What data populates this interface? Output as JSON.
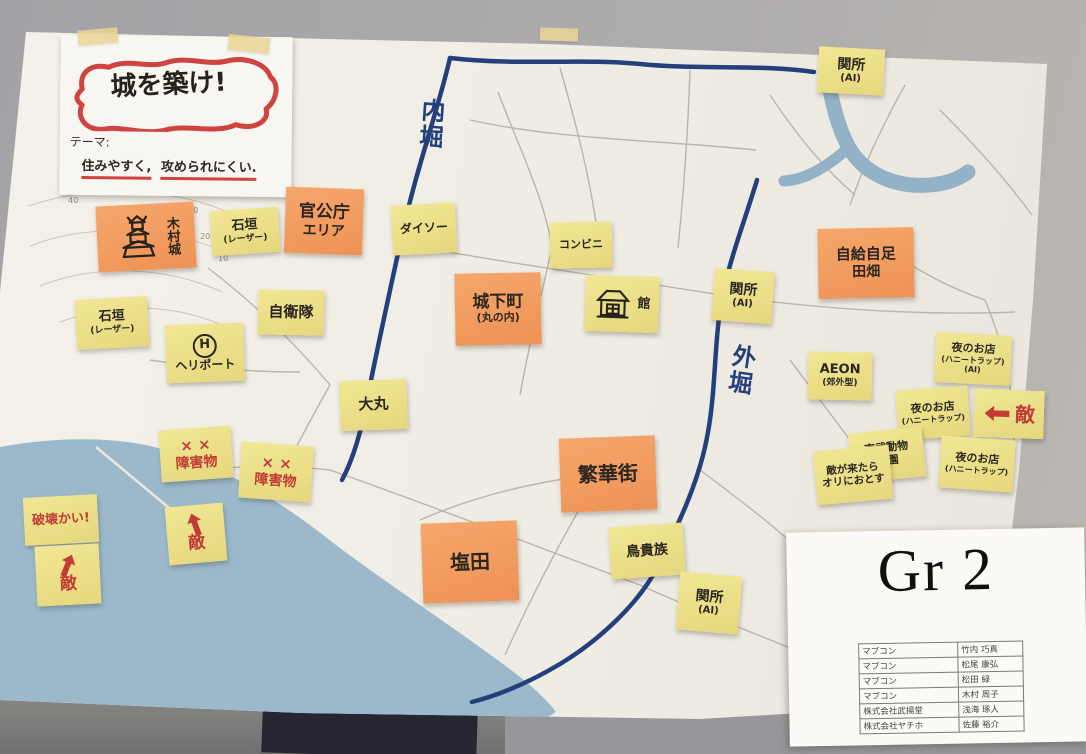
{
  "colors": {
    "note_yellow": "#ece28a",
    "note_orange": "#f29e62",
    "marker_red": "#c23b34",
    "marker_navy": "#24407c",
    "sea_blue": "#9cb9cc",
    "paper": "#f1eee7"
  },
  "title_card": {
    "title": "城を築け!",
    "theme_label": "テーマ:",
    "theme_part1": "住みやすく,",
    "theme_part2": "攻められにくい."
  },
  "map": {
    "inner_moat_label": "内堀",
    "outer_moat_label": "外堀",
    "contour_labels": [
      "40",
      "30",
      "20",
      "10"
    ]
  },
  "notes": {
    "sekisho_top": {
      "line1": "関所",
      "line2": "(AI)"
    },
    "kimura_castle": {
      "label": "木村城"
    },
    "ishigaki_1": {
      "line1": "石垣",
      "line2": "(レーザー)"
    },
    "gov_area": {
      "line1": "官公庁",
      "line2": "エリア"
    },
    "daiso": {
      "line1": "ダイソー"
    },
    "konbini": {
      "line1": "コンビニ"
    },
    "ishigaki_2": {
      "line1": "石垣",
      "line2": "(レーザー)"
    },
    "jieitai": {
      "line1": "自衛隊"
    },
    "heliport": {
      "symbol": "H",
      "line1": "ヘリポート"
    },
    "castle_town": {
      "line1": "城下町",
      "line2": "(丸の内)"
    },
    "house": {
      "label": "館"
    },
    "sekisho_mid": {
      "line1": "関所",
      "line2": "(AI)"
    },
    "jikyu": {
      "line1": "自給自足",
      "line2": "田畑"
    },
    "daimaru": {
      "line1": "大丸"
    },
    "aeon": {
      "line1": "AEON",
      "line2": "(郊外型)"
    },
    "yoru_1": {
      "line1": "夜のお店",
      "line2": "(ハニートラップ)",
      "line3": "(AI)"
    },
    "yoru_2": {
      "line1": "夜のお店",
      "line2": "(ハニートラップ)"
    },
    "yoru_3": {
      "line1": "夜のお店",
      "line2": "(ハニートラップ)"
    },
    "teki_right": {
      "label": "敵"
    },
    "teki_mid": {
      "label": "敵"
    },
    "teki_left": {
      "label": "敵"
    },
    "tobu_zoo": {
      "line1": "東武動物",
      "line2": "公園"
    },
    "ori": {
      "line1": "敵が来たら",
      "line2": "オリにおとす"
    },
    "hankagai": {
      "line1": "繁華街"
    },
    "torikizoku": {
      "line1": "鳥貴族"
    },
    "shioda": {
      "line1": "塩田"
    },
    "sekisho_bottom": {
      "line1": "関所",
      "line2": "(AI)"
    },
    "hakai": {
      "label": "破壊かい!"
    },
    "obstacles_1": {
      "marks": "× ×",
      "label": "障害物"
    },
    "obstacles_2": {
      "marks": "× ×",
      "label": "障害物"
    }
  },
  "group_card": {
    "title": "Gr 2",
    "members": [
      {
        "org": "マブコン",
        "name": "竹内 巧真"
      },
      {
        "org": "マブコン",
        "name": "松尾 康弘"
      },
      {
        "org": "マブコン",
        "name": "松田 緑"
      },
      {
        "org": "マブコン",
        "name": "木村 周子"
      },
      {
        "org": "株式会社武揚堂",
        "name": "浅海 琢人"
      },
      {
        "org": "株式会社ヤチホ",
        "name": "佐藤 裕介"
      }
    ]
  }
}
